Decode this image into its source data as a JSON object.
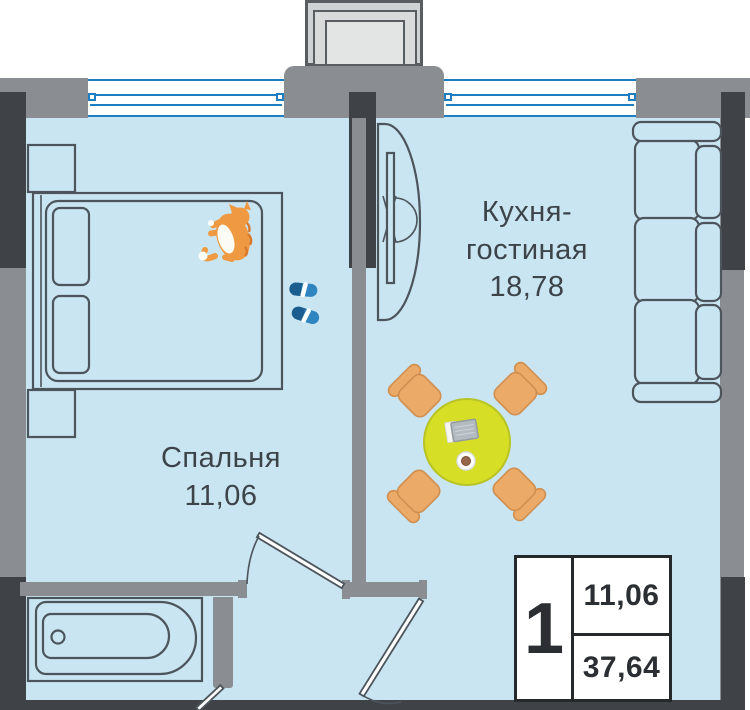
{
  "plan": {
    "rooms": [
      {
        "id": "kitchen-living",
        "name_line1": "Кухня-",
        "name_line2": "гостиная",
        "area": "18,78"
      },
      {
        "id": "bedroom",
        "name": "Спальня",
        "area": "11,06"
      }
    ],
    "legend": {
      "rooms_count": "1",
      "living_area": "11,06",
      "total_area": "37,64"
    },
    "colors": {
      "floor": "#c9e5f2",
      "wall": "#8a8e92",
      "wall_dark": "#3f4347",
      "outline": "#4d555c",
      "window_blue": "#1e7ec2",
      "table_yellow": "#d6de25",
      "table_edge": "#b8c324",
      "chair_orange": "#ecaa69",
      "chair_edge": "#d18f4f",
      "cat_orange": "#ef9a43",
      "cat_stripe": "#d8782e",
      "slipper_blue": "#2e85bf",
      "slipper_dark": "#1a5d8e",
      "room_text": "#3c4449",
      "legend_text": "#2b2f33",
      "legend_border": "#26292c"
    },
    "icons": [
      "bed-icon",
      "pillow-icon",
      "nightstand-icon",
      "cat-icon",
      "slippers-icon",
      "tv-icon",
      "sofa-icon",
      "dining-table-icon",
      "chair-icon",
      "tablet-icon",
      "cup-icon",
      "bathtub-icon",
      "window-icon",
      "door-icon",
      "vent-shaft-icon"
    ]
  }
}
